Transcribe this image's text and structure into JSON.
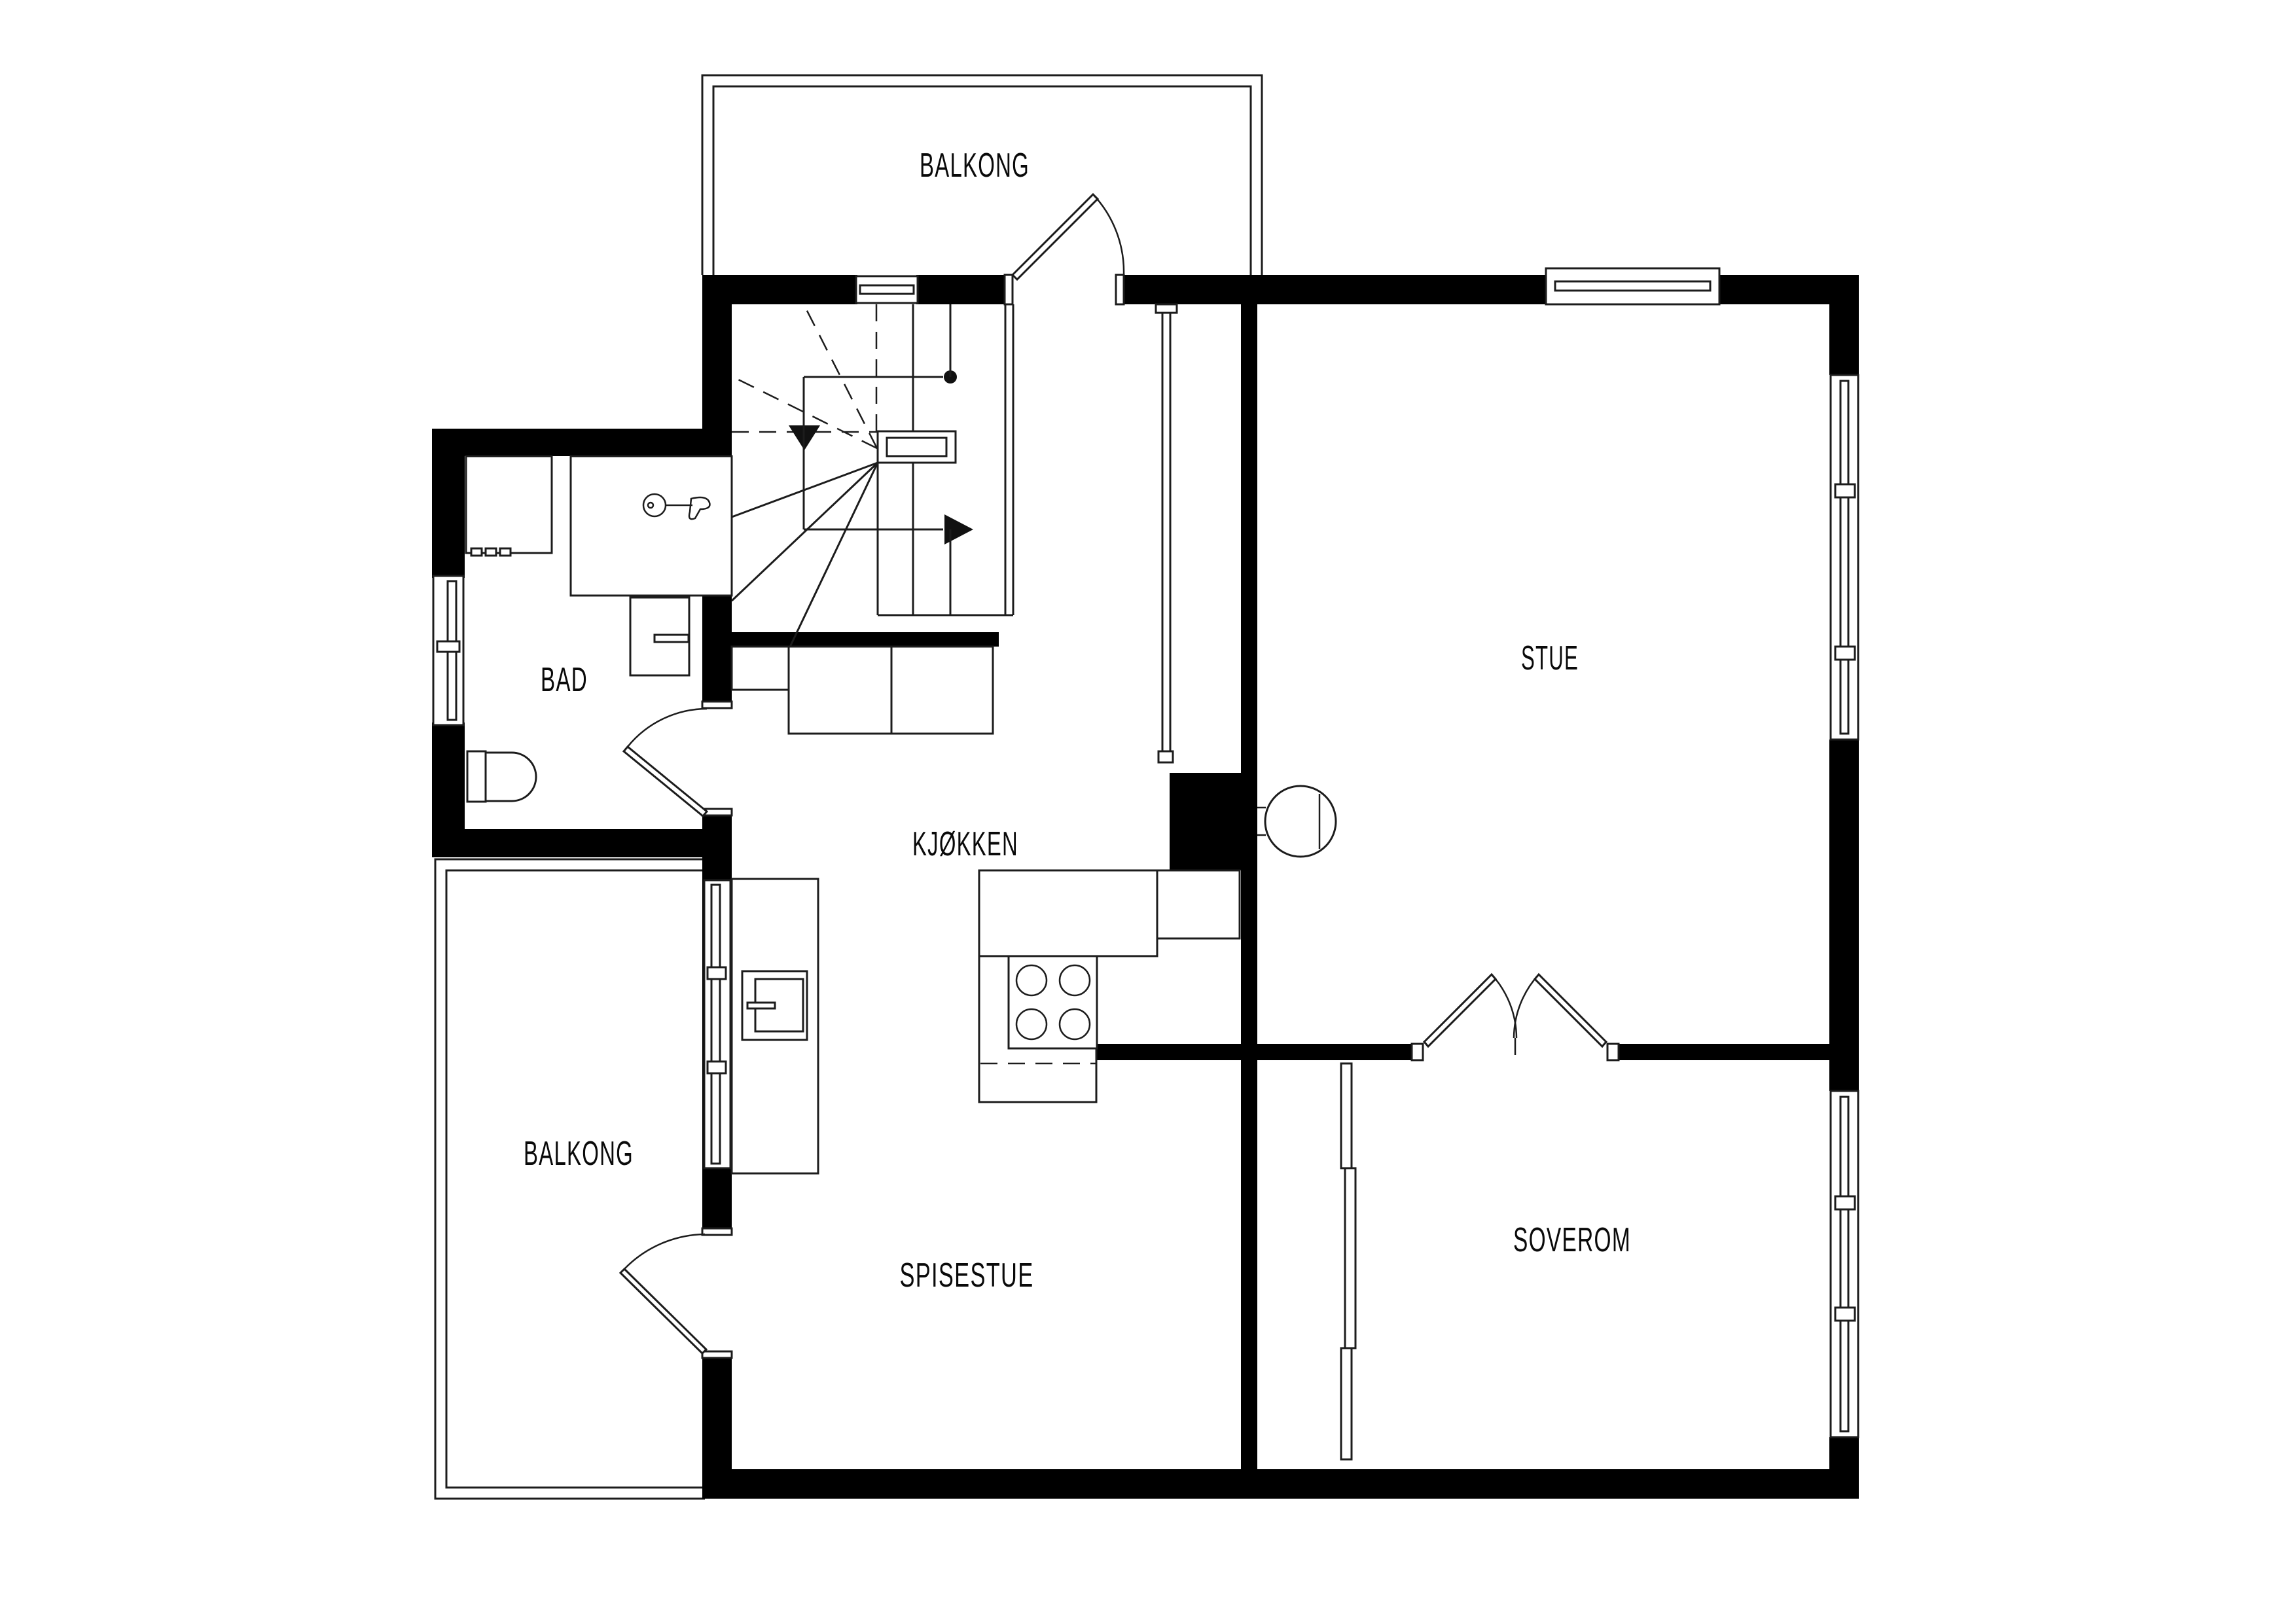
{
  "title": "Apartment floor plan",
  "colors": {
    "wall": "#000000",
    "line": "#1c1c1c",
    "background": "#ffffff"
  },
  "rooms": {
    "balcony_top": {
      "label": "BALKONG"
    },
    "stue": {
      "label": "STUE"
    },
    "bad": {
      "label": "BAD"
    },
    "kjokken": {
      "label": "KJØKKEN"
    },
    "balcony_left": {
      "label": "BALKONG"
    },
    "spisestue": {
      "label": "SPISESTUE"
    },
    "soverom": {
      "label": "SOVEROM"
    }
  },
  "fixtures": {
    "stairs": "winder-staircase",
    "toilet": "toilet",
    "sink": "washbasin-with-tap",
    "shower": "shower-cabinet",
    "washer": "washing-machine",
    "cooktop": "4-burner-cooktop",
    "wood_stove": "round-wood-stove",
    "chimney": "chimney-block",
    "wardrobe": "wardrobe",
    "kitchen_cabinets": "kitchen-counter",
    "island_stove": "stove-cabinet"
  }
}
